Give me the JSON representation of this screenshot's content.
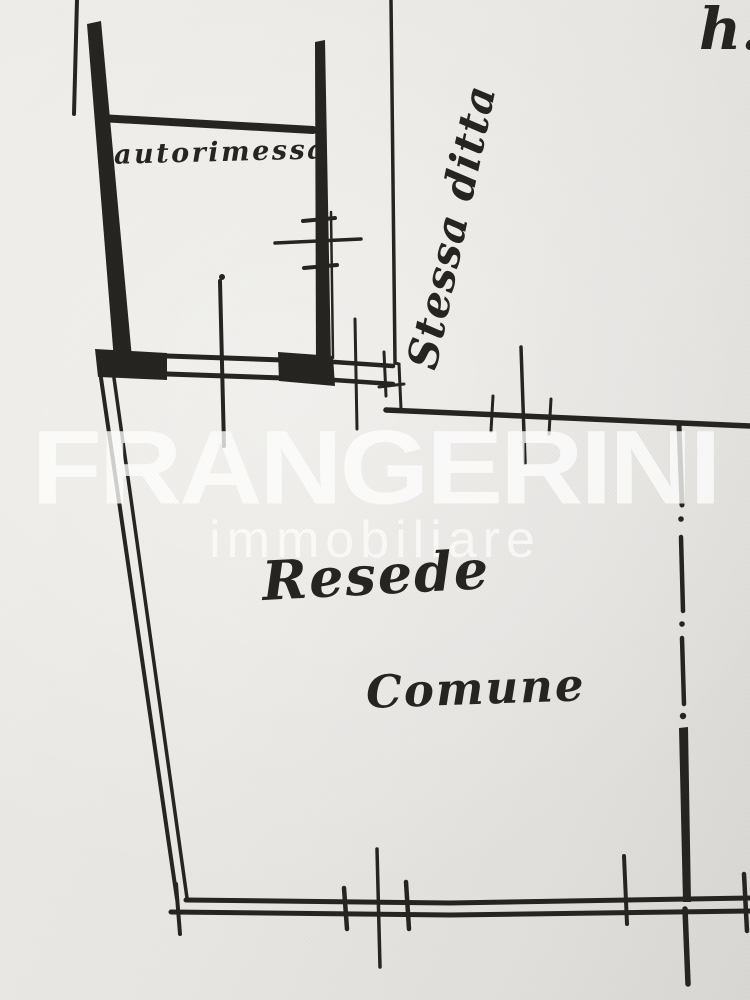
{
  "watermark": {
    "brand": "FRANGERINI",
    "subtitle": "immobiliare"
  },
  "labels": {
    "room": "autorimessa",
    "adjacent_note": "Stessa ditta",
    "height_abbrev": "h.",
    "yard_line1": "Resede",
    "yard_line2": "Comune"
  },
  "colors": {
    "ink": "#23211e",
    "paper": "#e8e6e2",
    "watermark": "#ffffff"
  }
}
